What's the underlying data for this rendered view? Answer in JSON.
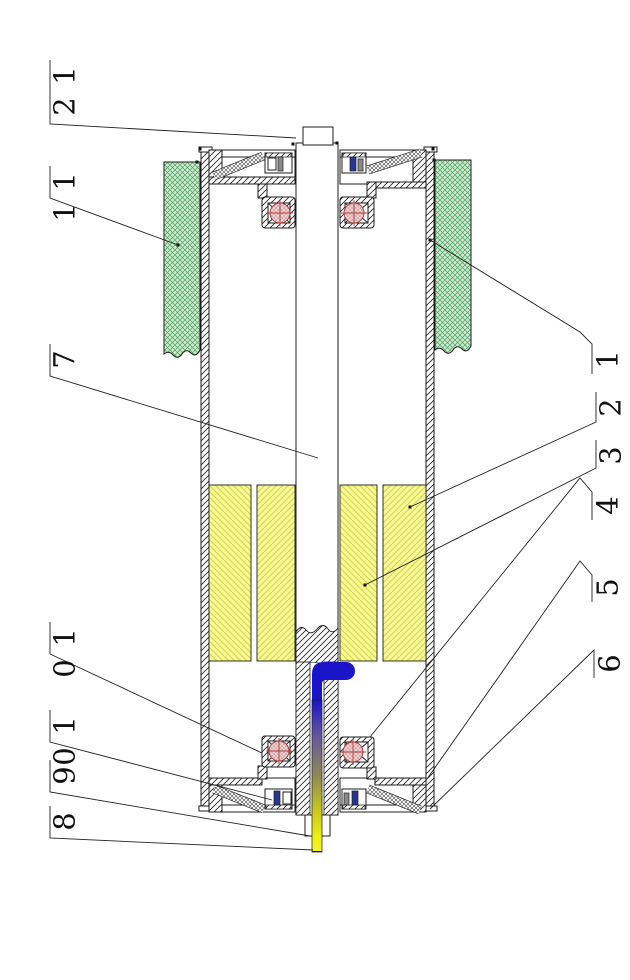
{
  "figure": {
    "kind": "patent cross-section drawing",
    "subject": "motorized drum roller sectional view with numbered part callouts"
  },
  "colors": {
    "green_fill": "#cdeccd",
    "green_line": "#4d9e63",
    "yellow_fill": "#f8f894",
    "yellow_line": "#d2d24e",
    "bearing_fill": "#f2dcdc",
    "bearing_line": "#c89090",
    "bearing_accent": "#b03a3a",
    "cable_blue": "#1a15c8",
    "cable_yellow": "#f2ef1a",
    "seal_blue": "#283593",
    "seal_gray": "#8a8a8a",
    "line": "#1c1c1c"
  },
  "callouts": [
    {
      "id": "12",
      "text": "12",
      "side": "left",
      "label_x": 52,
      "label_y": 60,
      "points": [
        [
          50,
          60
        ],
        [
          50,
          124
        ],
        [
          296,
          138
        ]
      ]
    },
    {
      "id": "11",
      "text": "11",
      "side": "left",
      "label_x": 52,
      "label_y": 166,
      "points": [
        [
          50,
          166
        ],
        [
          50,
          198
        ],
        [
          178,
          245
        ]
      ]
    },
    {
      "id": "7",
      "text": "7",
      "side": "left",
      "label_x": 52,
      "label_y": 344,
      "points": [
        [
          50,
          344
        ],
        [
          50,
          376
        ],
        [
          318,
          458
        ]
      ]
    },
    {
      "id": "10a",
      "text": "10",
      "side": "left",
      "label_x": 52,
      "label_y": 622,
      "points": [
        [
          50,
          622
        ],
        [
          50,
          654
        ],
        [
          262,
          753
        ]
      ]
    },
    {
      "id": "10b",
      "text": "10",
      "side": "left",
      "label_x": 52,
      "label_y": 710,
      "points": [
        [
          50,
          710
        ],
        [
          50,
          742
        ],
        [
          272,
          800
        ]
      ]
    },
    {
      "id": "9",
      "text": "9",
      "side": "left",
      "label_x": 52,
      "label_y": 760,
      "points": [
        [
          50,
          760
        ],
        [
          50,
          792
        ],
        [
          310,
          836
        ]
      ]
    },
    {
      "id": "8",
      "text": "8",
      "side": "left",
      "label_x": 52,
      "label_y": 806,
      "points": [
        [
          50,
          806
        ],
        [
          50,
          838
        ],
        [
          313,
          850
        ]
      ]
    },
    {
      "id": "1",
      "text": "1",
      "side": "right",
      "label_x": 595,
      "label_y": 344,
      "points": [
        [
          592,
          374
        ],
        [
          592,
          344
        ],
        [
          580,
          332
        ],
        [
          430,
          240
        ]
      ]
    },
    {
      "id": "2",
      "text": "2",
      "side": "right",
      "label_x": 598,
      "label_y": 392,
      "points": [
        [
          596,
          392
        ],
        [
          596,
          422
        ],
        [
          410,
          507
        ]
      ]
    },
    {
      "id": "3",
      "text": "3",
      "side": "right",
      "label_x": 598,
      "label_y": 440,
      "points": [
        [
          596,
          440
        ],
        [
          596,
          468
        ],
        [
          365,
          585
        ]
      ]
    },
    {
      "id": "4",
      "text": "4",
      "side": "right",
      "label_x": 595,
      "label_y": 490,
      "points": [
        [
          592,
          520
        ],
        [
          592,
          492
        ],
        [
          580,
          478
        ],
        [
          370,
          737
        ]
      ]
    },
    {
      "id": "5",
      "text": "5",
      "side": "right",
      "label_x": 595,
      "label_y": 572,
      "points": [
        [
          592,
          602
        ],
        [
          592,
          575
        ],
        [
          580,
          561
        ],
        [
          427,
          779
        ]
      ]
    },
    {
      "id": "6",
      "text": "6",
      "side": "right",
      "label_x": 597,
      "label_y": 648,
      "points": [
        [
          594,
          678
        ],
        [
          594,
          650
        ],
        [
          430,
          809
        ]
      ]
    }
  ]
}
